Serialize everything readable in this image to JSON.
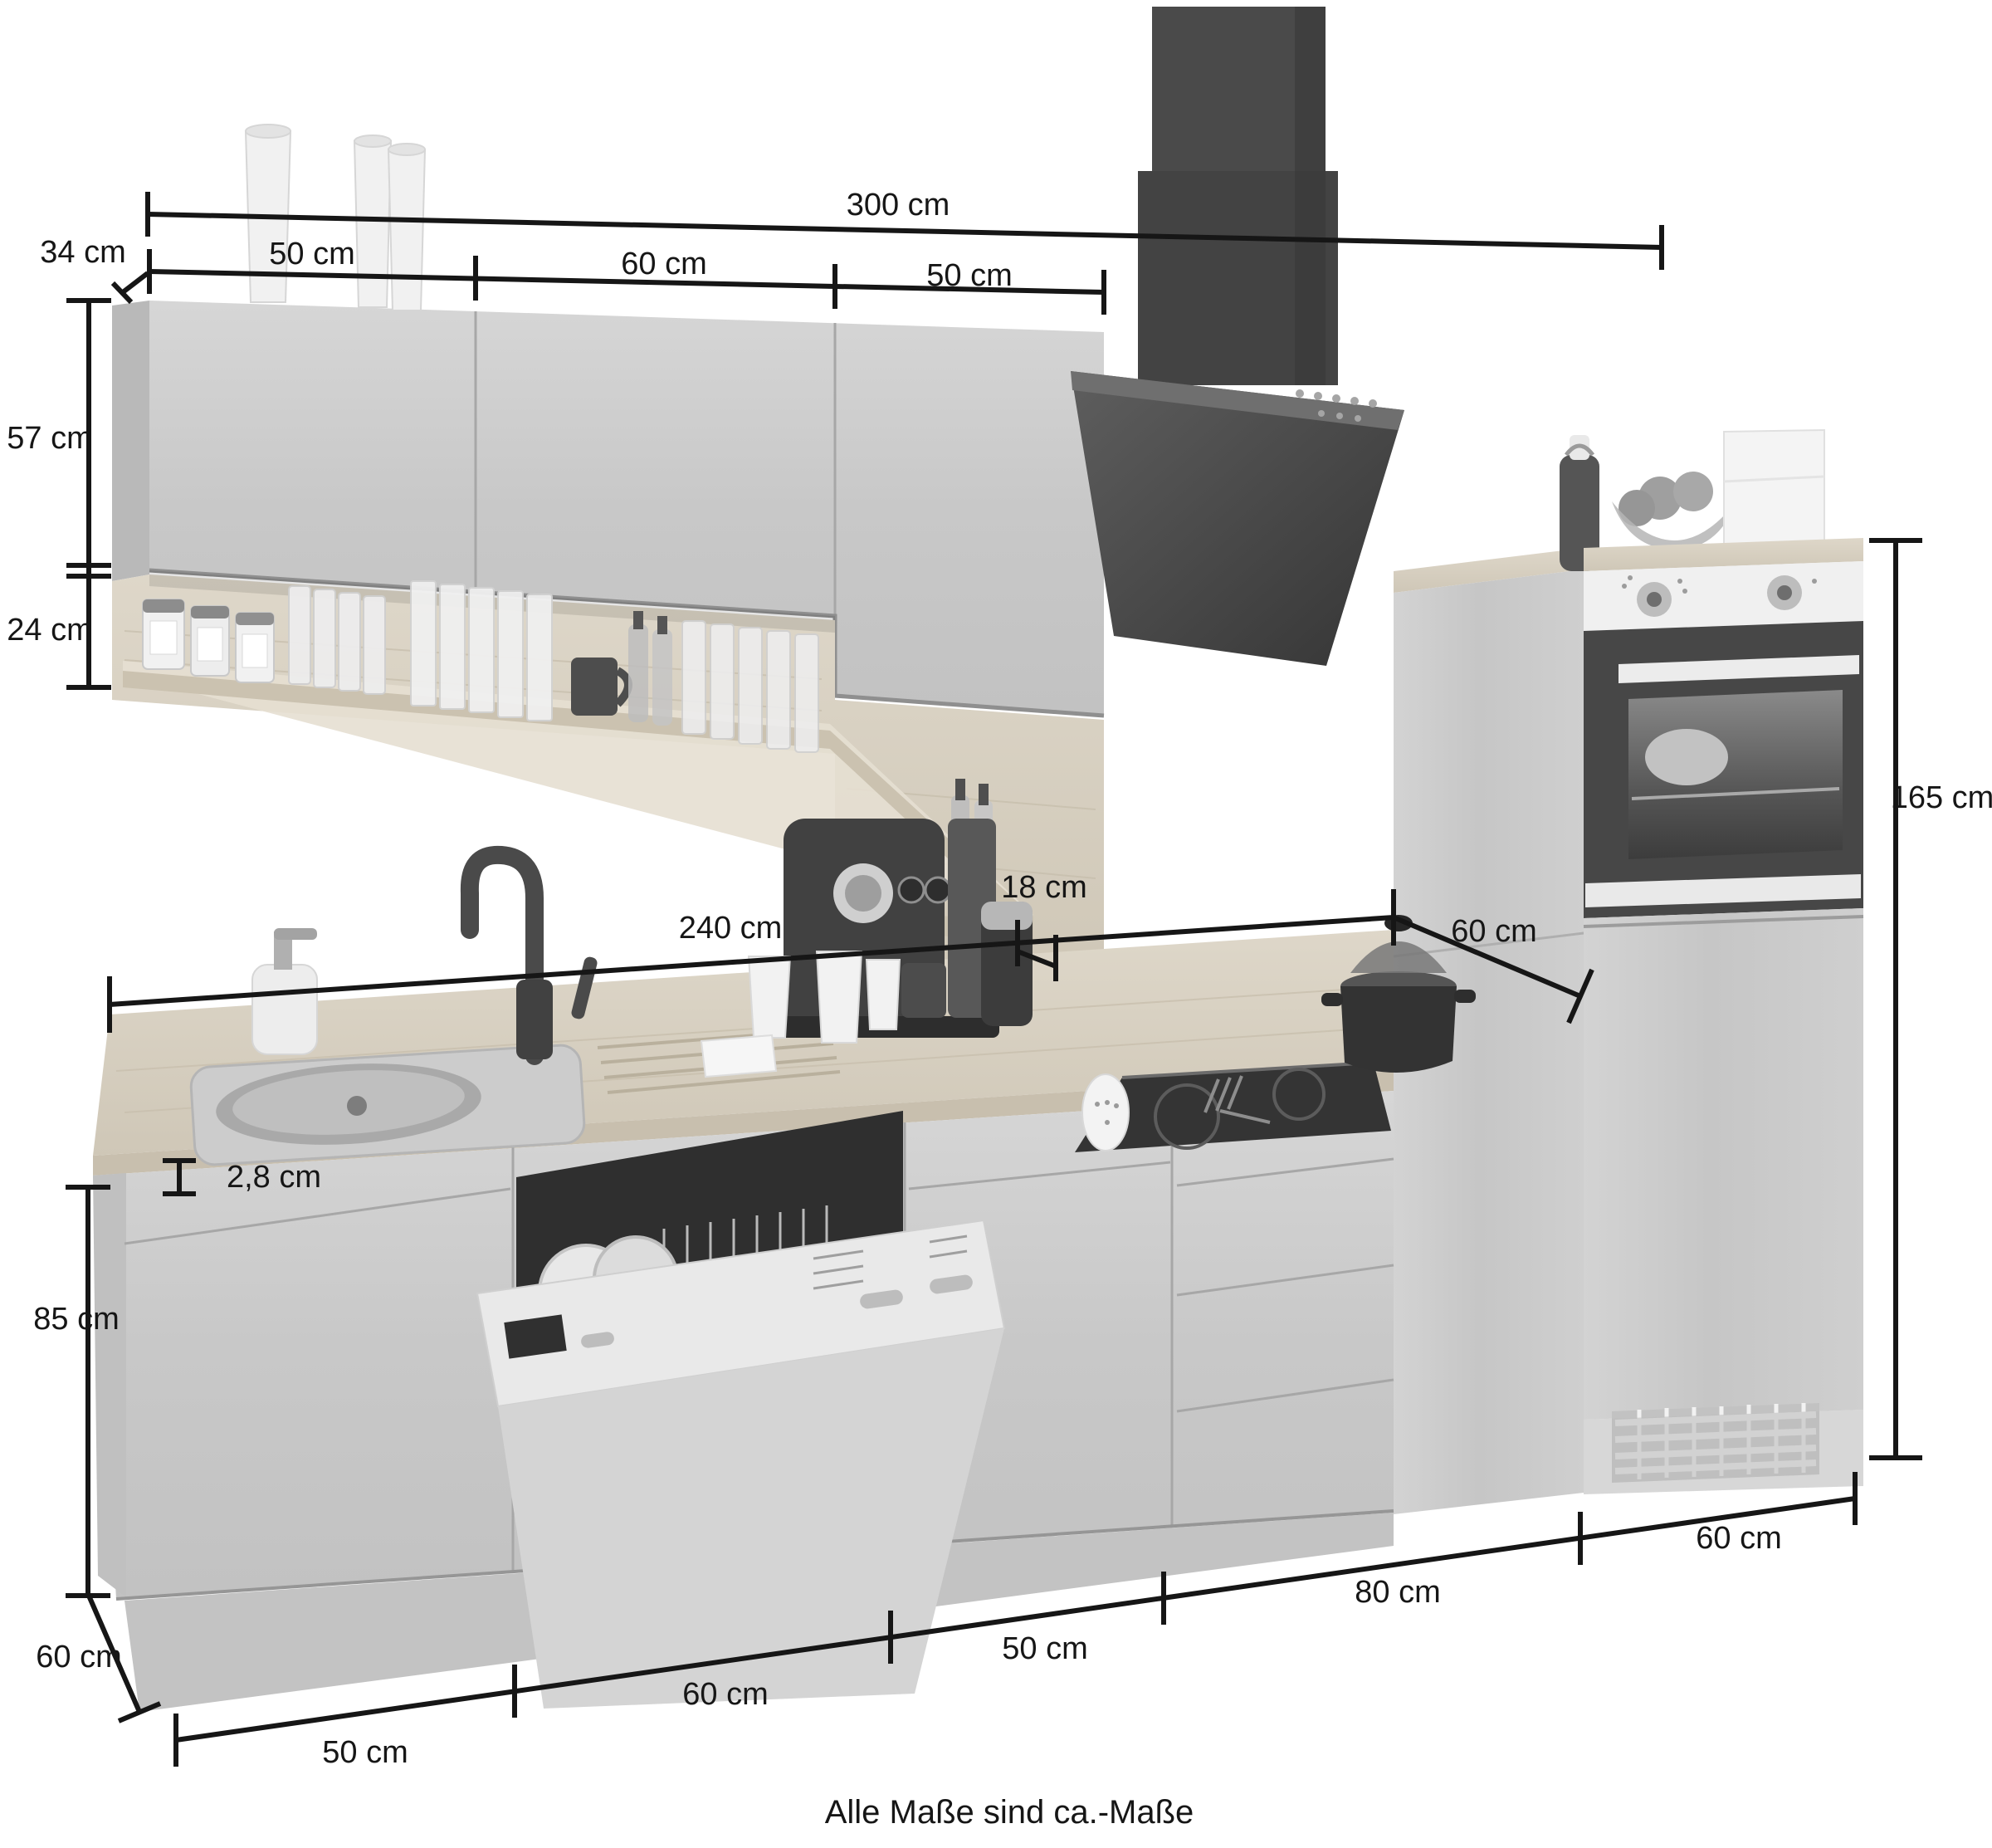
{
  "image_type": "product-dimension-diagram",
  "subject": "kitchen cabinet set with appliances (grayscale product render)",
  "units": "cm",
  "note": "Alle Maße sind ca.-Maße",
  "colors": {
    "background": "#ffffff",
    "dimension_line": "#161616",
    "cabinet_gloss": "#cccccc",
    "wood_tone": "#d8d1c3",
    "appliance_dark": "#444444",
    "appliance_white": "#f0f0f0"
  },
  "annotations": {
    "top_total_width": "300 cm",
    "wall_unit_depth": "34 cm",
    "wall_unit_segments": [
      "50 cm",
      "60 cm",
      "50 cm"
    ],
    "wall_cabinet_height": "57 cm",
    "shelf_panel_height": "24 cm",
    "shelf_board_depth": "18 cm",
    "worktop_run_width": "240 cm",
    "tall_unit_depth": "60 cm",
    "tall_unit_height": "165 cm",
    "worktop_thickness": "2,8 cm",
    "base_unit_height": "85 cm",
    "base_unit_depth": "60 cm",
    "base_segments": [
      "50 cm",
      "60 cm",
      "50 cm",
      "80 cm",
      "60 cm"
    ]
  },
  "dimensions_cm": {
    "total_width": 300,
    "worktop_run_width": 240,
    "wall_cabinet_height": 57,
    "shelf_panel_height": 24,
    "wall_unit_depth": 34,
    "shelf_board_depth": 18,
    "tall_unit_height": 165,
    "tall_unit_depth": 60,
    "base_unit_height": 85,
    "base_unit_depth": 60,
    "worktop_thickness": 2.8,
    "wall_segment_widths": [
      50,
      60,
      50
    ],
    "base_segment_widths": [
      50,
      60,
      50,
      80,
      60
    ]
  }
}
